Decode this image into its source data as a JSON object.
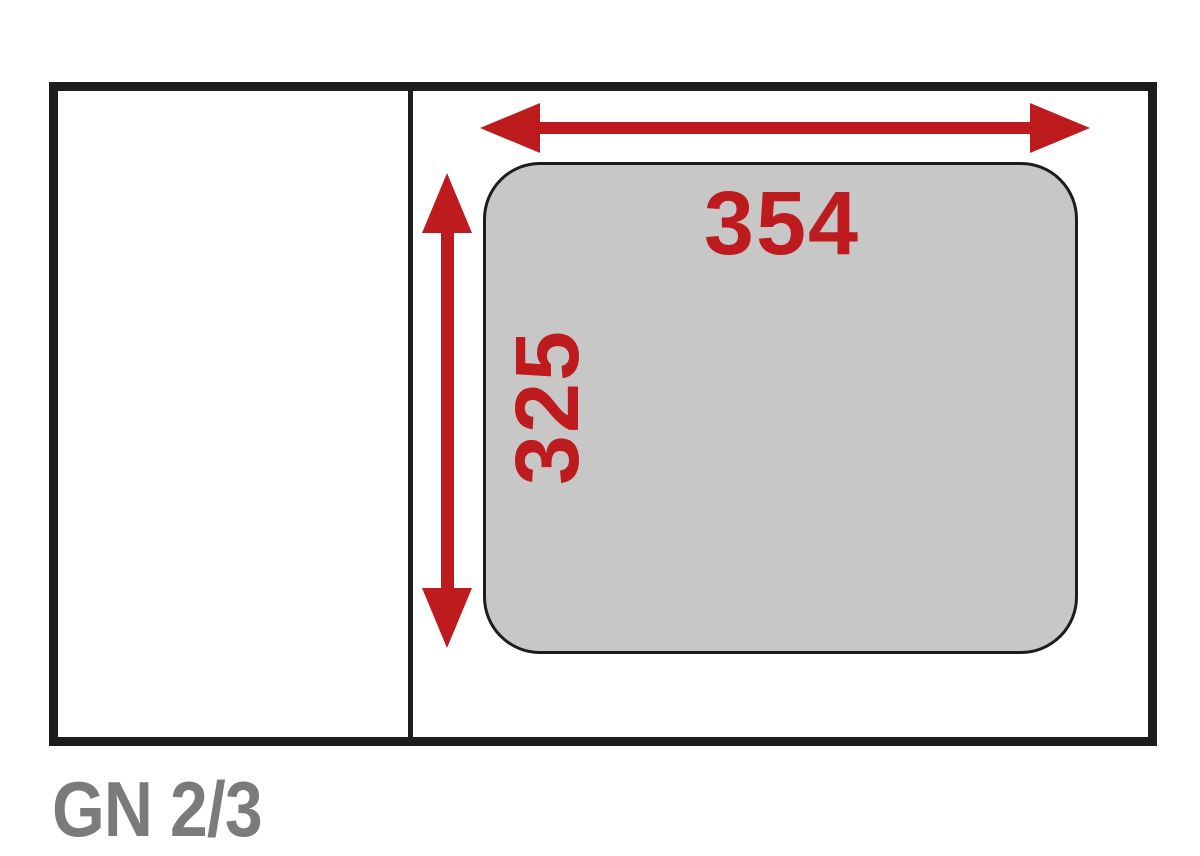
{
  "labels": {
    "caption": "GN 2/3",
    "width_mm": "354",
    "height_mm": "325"
  },
  "icons": {
    "width_arrow": "horizontal-double-headed-dimension-arrow",
    "height_arrow": "vertical-double-headed-dimension-arrow"
  },
  "colors": {
    "dimension_red": "#be1b1f",
    "outline_black": "#1d1d1b",
    "pan_fill": "#c7c7c8",
    "caption_gray": "#7b7b7b"
  }
}
